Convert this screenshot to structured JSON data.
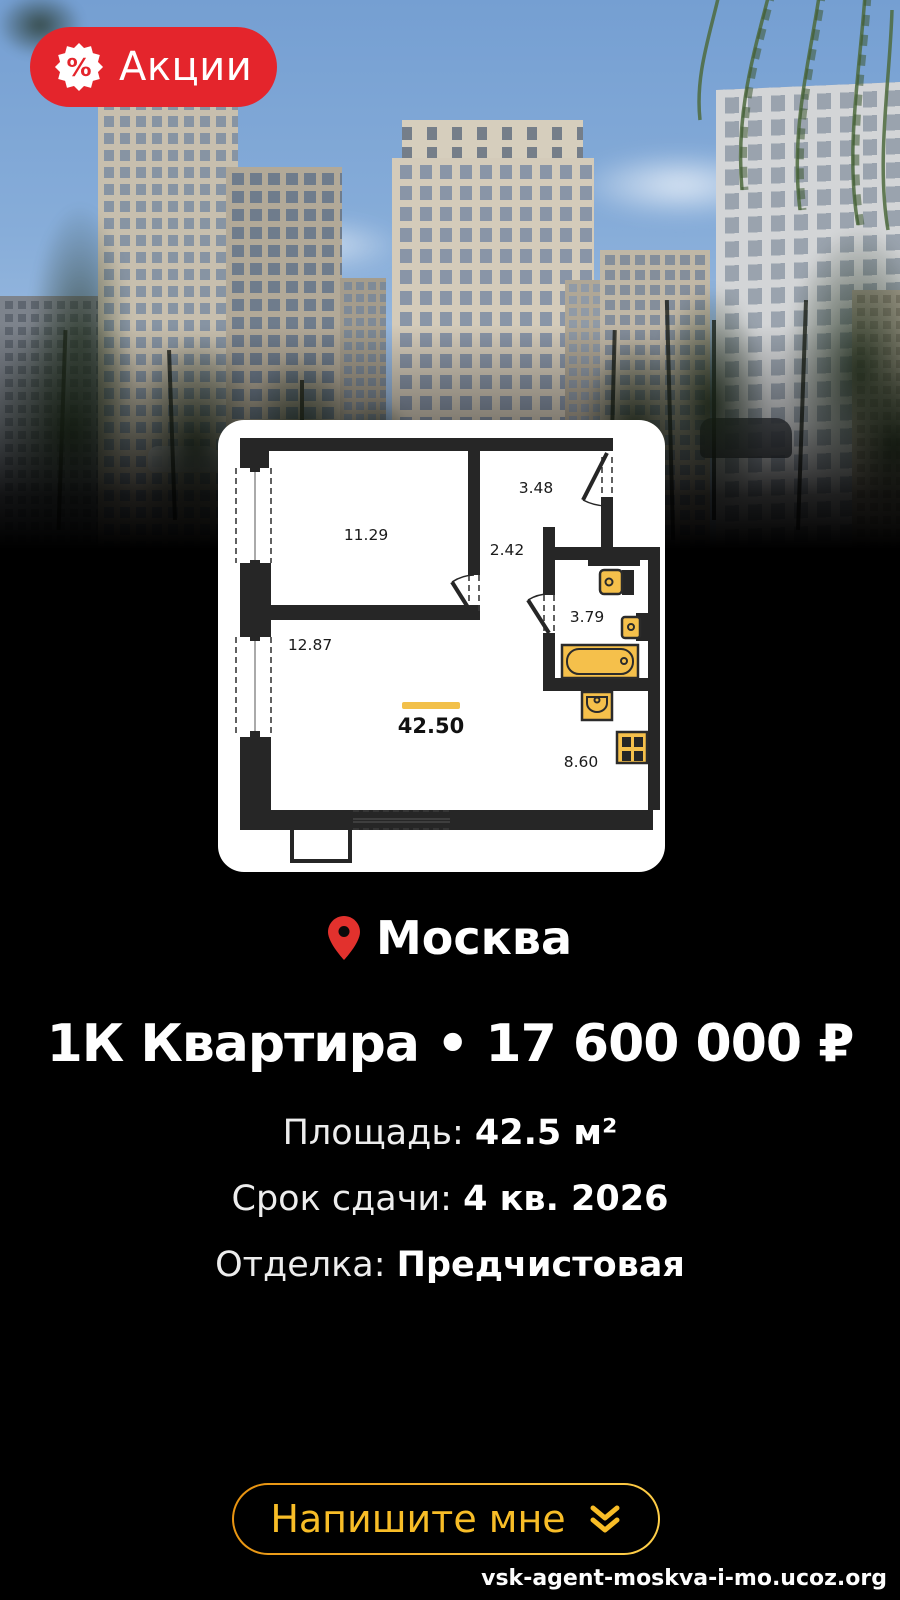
{
  "badge": {
    "label": "Акции",
    "percent_symbol": "%"
  },
  "floor_plan": {
    "total_area": "42.50",
    "rooms": {
      "bedroom": "11.29",
      "hall": "3.48",
      "corridor": "2.42",
      "bathroom": "3.79",
      "living": "12.87",
      "kitchen": "8.60"
    }
  },
  "location": {
    "city": "Москва"
  },
  "listing": {
    "title": "1К Квартира • 17 600 000 ₽"
  },
  "specs": [
    {
      "label": "Площадь:",
      "value": "42.5 м²"
    },
    {
      "label": "Срок сдачи:",
      "value": "4 кв. 2026"
    },
    {
      "label": "Отделка:",
      "value": "Предчистовая"
    }
  ],
  "cta": {
    "label": "Напишите мне"
  },
  "watermark": "vsk-agent-moskva-i-mo.ucoz.org",
  "colors": {
    "badge_red": "#E4252C",
    "pin_red": "#E2312D",
    "gold": "#F8BD27",
    "plan_fixture_yellow": "#F5C04B",
    "plan_wall": "#262626"
  }
}
